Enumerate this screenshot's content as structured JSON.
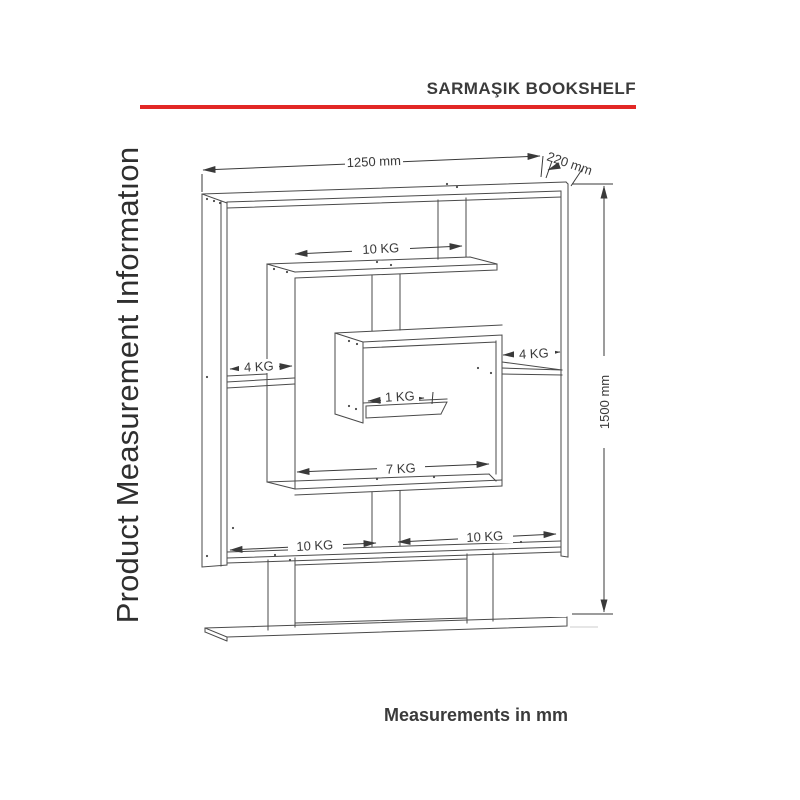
{
  "page": {
    "title": "SARMAŞIK BOOKSHELF",
    "side_label": "Product Measurement Informatıon",
    "footer_note": "Measurements in mm",
    "accent_color": "#e22725"
  },
  "diagram": {
    "dimensions": {
      "width": "1250 mm",
      "depth": "220 mm",
      "height": "1500 mm"
    },
    "shelf_capacities": {
      "top_shelf": "10 KG",
      "left_shelf": "4 KG",
      "right_shelf": "4 KG",
      "center_box_shelf": "1 KG",
      "middle_shelf": "7 KG",
      "bottom_left_shelf": "10 KG",
      "bottom_right_shelf": "10 KG"
    }
  }
}
